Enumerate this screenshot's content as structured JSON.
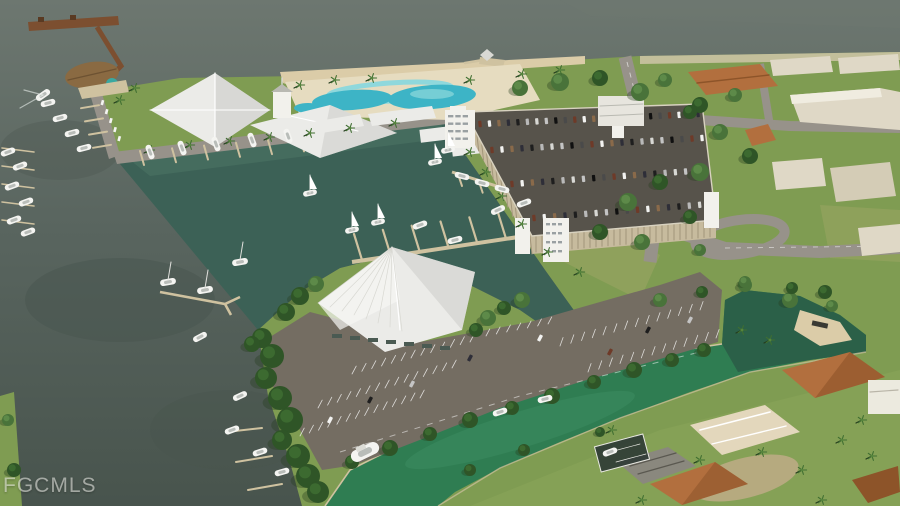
{
  "watermark": {
    "text": "FGCMLS"
  },
  "scene": {
    "description": "Aerial architectural rendering of a waterfront marina resort: fishing pier, clubhouse with pool complex and beach, marina basin with docks and sailboats, dry-storage garage with rooftop parking, event pavilion, surface parking lot, green canal with boats and boat ramp, canal-front homes and industrial buildings",
    "colors": {
      "bay_light": "#6d7770",
      "bay_water": "#59655f",
      "bay_deep": "#48544d",
      "marina_water": "#3c6156",
      "marina_shallow": "#55806c",
      "canal_water": "#2f7d52",
      "canal_light": "#45946a",
      "basin_water": "#2b5d47",
      "pool_water": "#3db4c6",
      "pool_light": "#8fd8dc",
      "sand": "#dbcca8",
      "deck_sand": "#e6dcc0",
      "lawn": "#7f9c52",
      "lawn_light": "#93ac5e",
      "dry_grass": "#a5a968",
      "tree_dark": "#2f5527",
      "tree_mid": "#49733a",
      "palm": "#3f6e31",
      "road": "#97928a",
      "asphalt": "#746d62",
      "roof_white": "#ebebe8",
      "roof_shadow": "#c9c9c5",
      "garage_wall": "#c7bb9e",
      "garage_rib": "#a2957a",
      "garage_deck": "#57534b",
      "tower_white": "#f2f1ec",
      "pier_brown": "#7c4f30",
      "dock_tan": "#cfc2a0",
      "boat_white": "#f4f4f1",
      "roof_orange": "#b26f3e",
      "roof_orange_dark": "#8d5429",
      "house_tan": "#d8c6a2",
      "warehouse": "#dfd8c6",
      "dirt": "#c2ad8a",
      "watermark": "rgba(245,245,240,0.55)"
    }
  }
}
